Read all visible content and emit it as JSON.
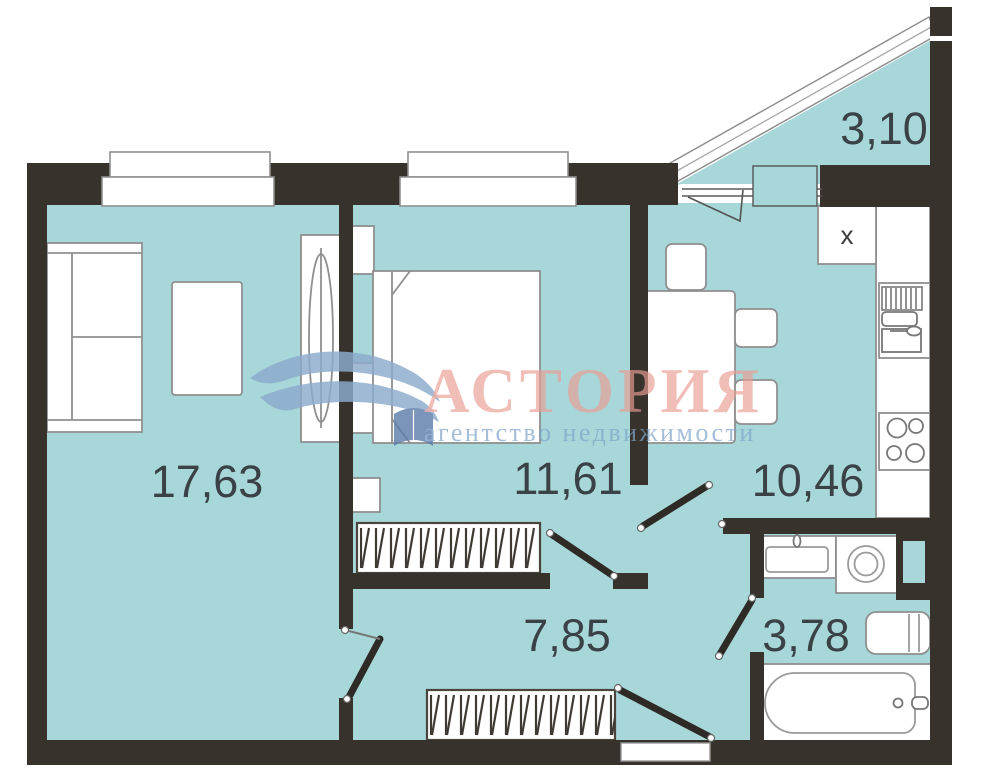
{
  "watermark": {
    "brand": "АСТОРИЯ",
    "subtitle": "агентство недвижимости"
  },
  "rooms": {
    "living": {
      "area": "17,63"
    },
    "bedroom": {
      "area": "11,61"
    },
    "kitchen": {
      "area": "10,46"
    },
    "hall": {
      "area": "7,85"
    },
    "bathroom": {
      "area": "3,78"
    },
    "balcony": {
      "area": "3,10"
    }
  },
  "fixtures": {
    "kitchen_cabinet_mark": "x"
  },
  "colors": {
    "floor": "#a7d7d8",
    "wall": "#37322c",
    "label": "#3a4147",
    "brand": "#e99d95",
    "subtitle": "#7ea3c9"
  }
}
